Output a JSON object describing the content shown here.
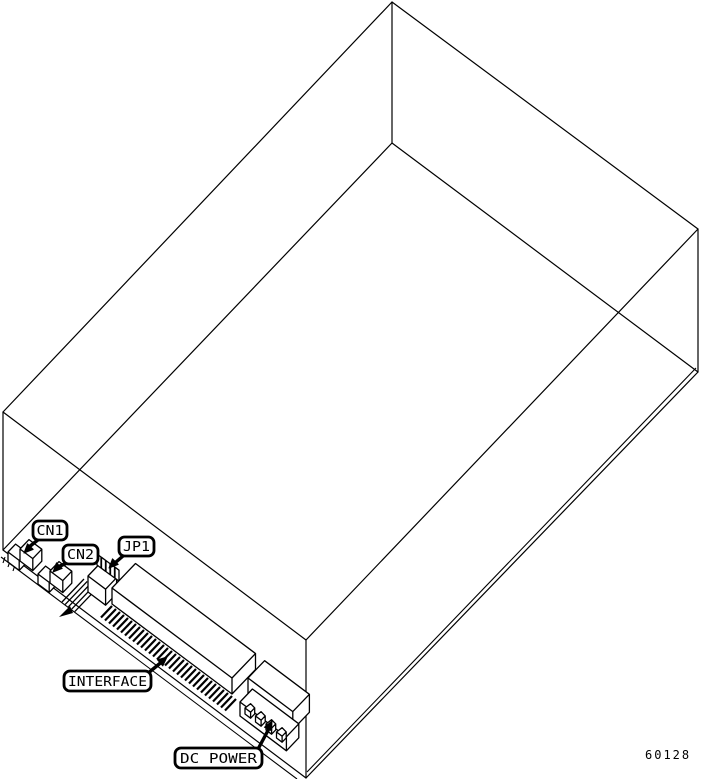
{
  "figure": {
    "background_color": "#ffffff",
    "line_color": "#000000",
    "figure_number": "60128"
  },
  "callouts": {
    "cn1": {
      "label": "CN1"
    },
    "cn2": {
      "label": "CN2"
    },
    "jp1": {
      "label": "JP1"
    },
    "interface": {
      "label": "INTERFACE"
    },
    "dc_power": {
      "label": "DC POWER"
    }
  }
}
